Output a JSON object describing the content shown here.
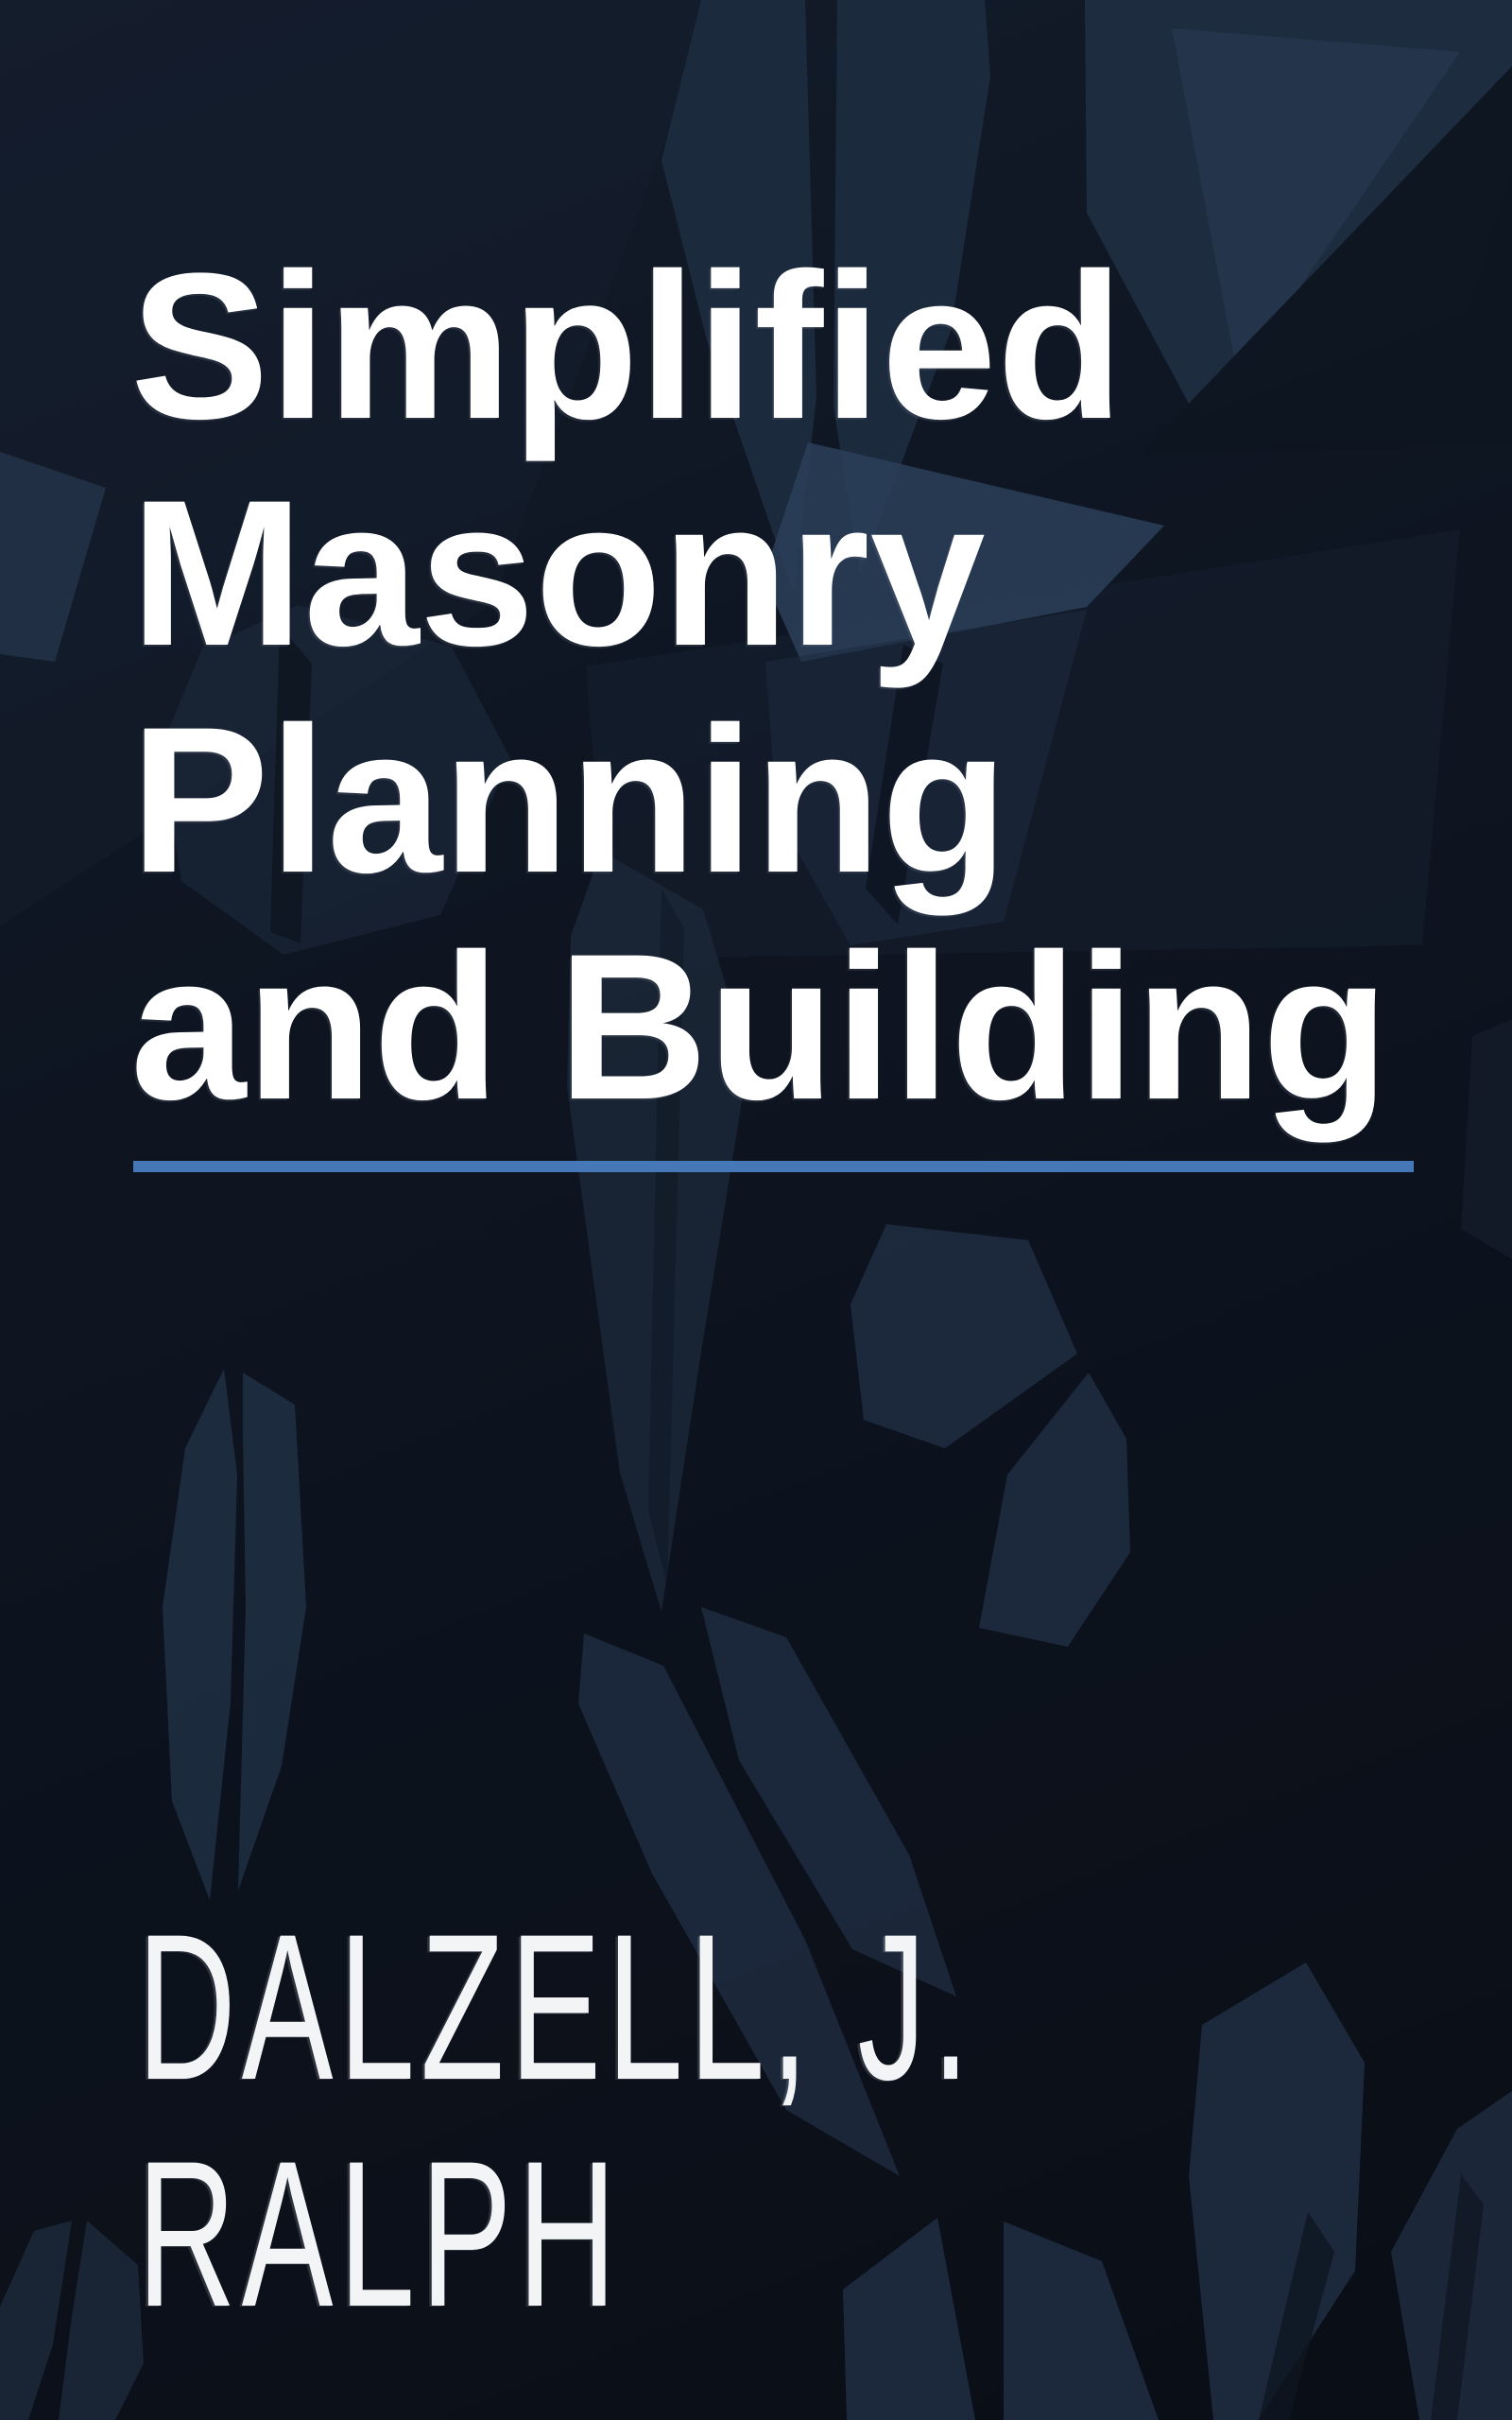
{
  "cover": {
    "title": {
      "full": "Simplified Masonry Planning and Building",
      "lines": [
        "Simplified",
        "Masonry",
        "Planning",
        "and Building"
      ]
    },
    "author": {
      "full": "DALZELL, J. RALPH",
      "lines": [
        "DALZELL, J.",
        "RALPH"
      ]
    },
    "decor": {
      "pattern": "low-poly-leaf-shapes"
    },
    "colors": {
      "background_top": "#131c2b",
      "background": "#0e1521",
      "background_bottom": "#0a0e16",
      "leaf": "#1e2c40",
      "leaf_light": "#2c4059",
      "leaf_dark": "#16202f",
      "leaf_muted": "#1b2737",
      "title_text": "#ffffff",
      "author_text": "#f3f4f6",
      "divider_blue": "#4678b8"
    }
  }
}
